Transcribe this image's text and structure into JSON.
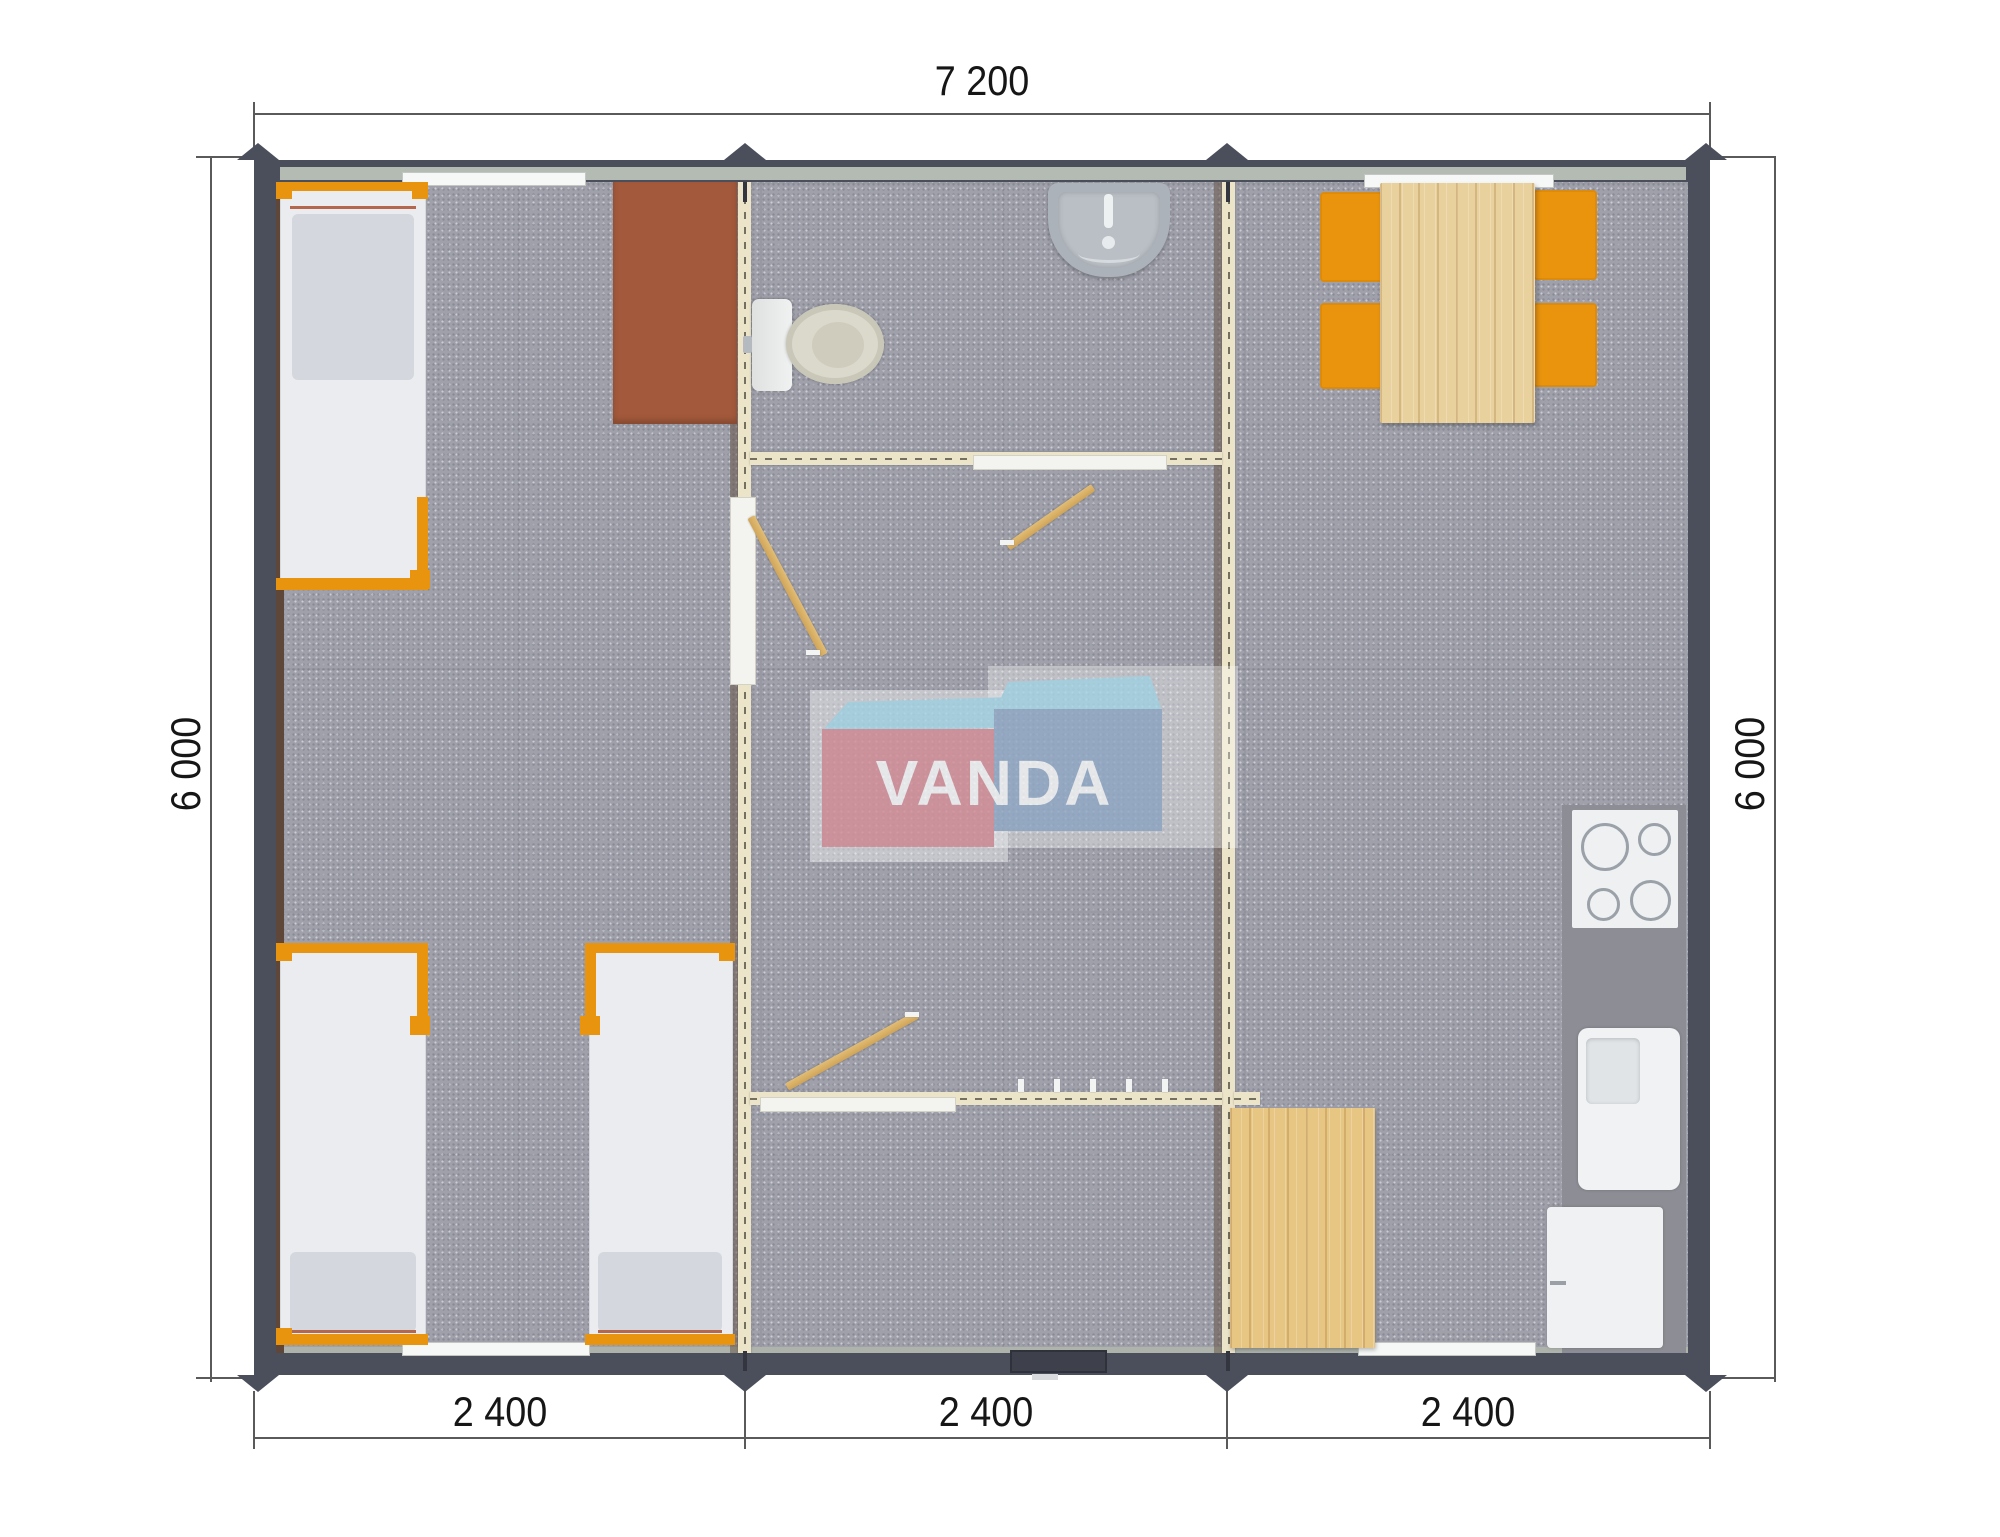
{
  "watermark": {
    "text": "VANDA"
  },
  "dimensions": {
    "top_width": "7 200",
    "left_height": "6 000",
    "right_height": "6 000",
    "bottom_widths": [
      "2 400",
      "2 400",
      "2 400"
    ]
  },
  "colors": {
    "outer_wall": "#4b4f5b",
    "interior_wall": "#ece4c9",
    "furniture_orange": "#e8940f",
    "wood_light": "#e9d19e",
    "desk_brown": "#a3593b",
    "floor_gray": "#9fa0aa",
    "logo_pink": "#d7909a",
    "logo_blue": "#92aac8",
    "logo_sky": "#a7d7e7"
  },
  "icons": {
    "bed": "css-rect",
    "pillow": "css-rect",
    "desk": "css-rect",
    "toilet": "css-ellipse",
    "wash-basin": "css-rounded-rect",
    "dining-table": "css-wood-rect",
    "dining-chair": "css-rect",
    "cooktop": "css-circles",
    "kitchen-sink": "css-rounded-rect",
    "refrigerator": "css-rect",
    "floor-mat": "css-wood-rect",
    "door-swing": "css-rotated-bar",
    "coat-hook": "css-tick",
    "module-joint-marker": "css-triangle"
  }
}
